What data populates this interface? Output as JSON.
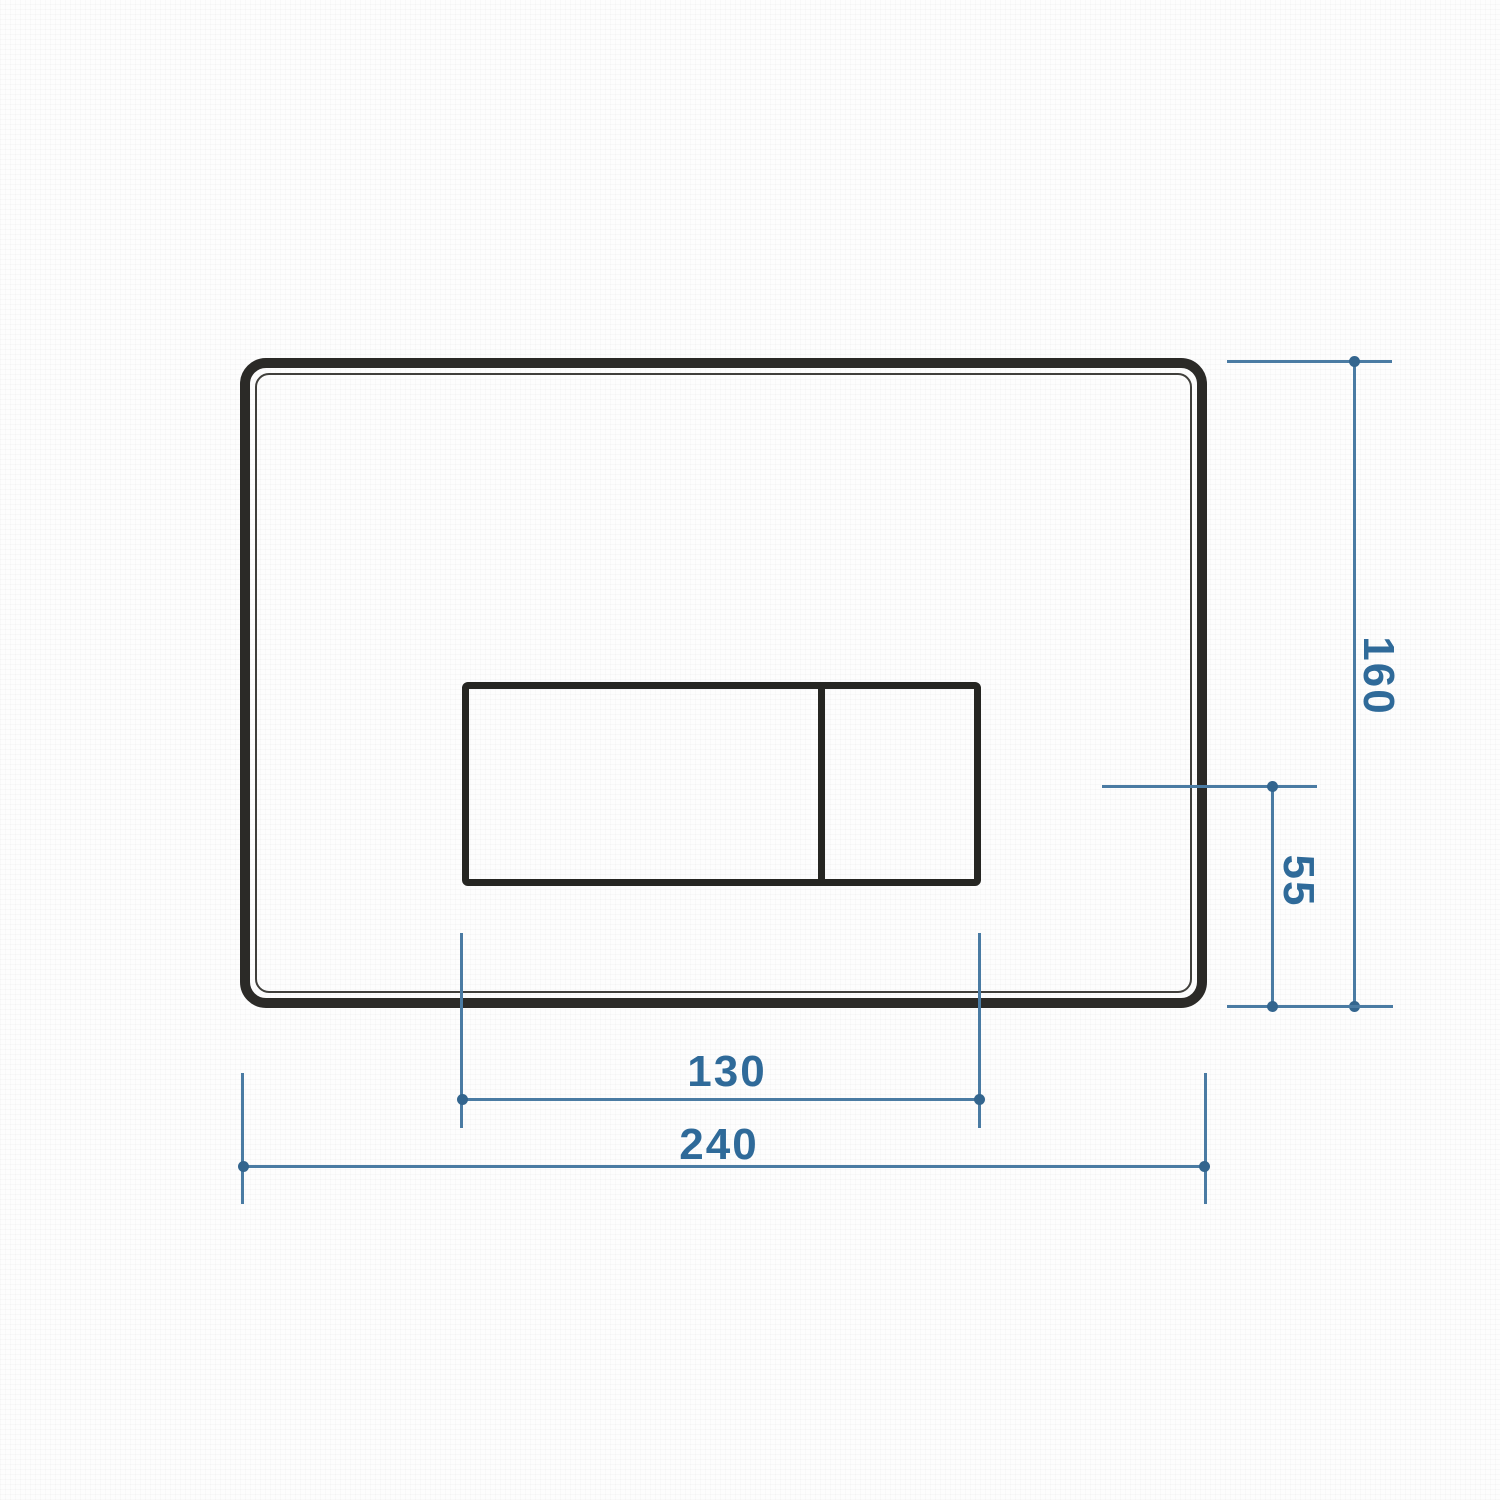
{
  "drawing": {
    "dimension_labels": {
      "plate_height": "160",
      "button_offset_bottom": "55",
      "buttons_width": "130",
      "plate_width": "240"
    },
    "colors": {
      "outline_dark": "#2b2a27",
      "dimension_line": "#4a7ba3",
      "dimension_dot": "#33658e",
      "dimension_text": "#2f6a99",
      "background": "#fdfdfd"
    }
  }
}
